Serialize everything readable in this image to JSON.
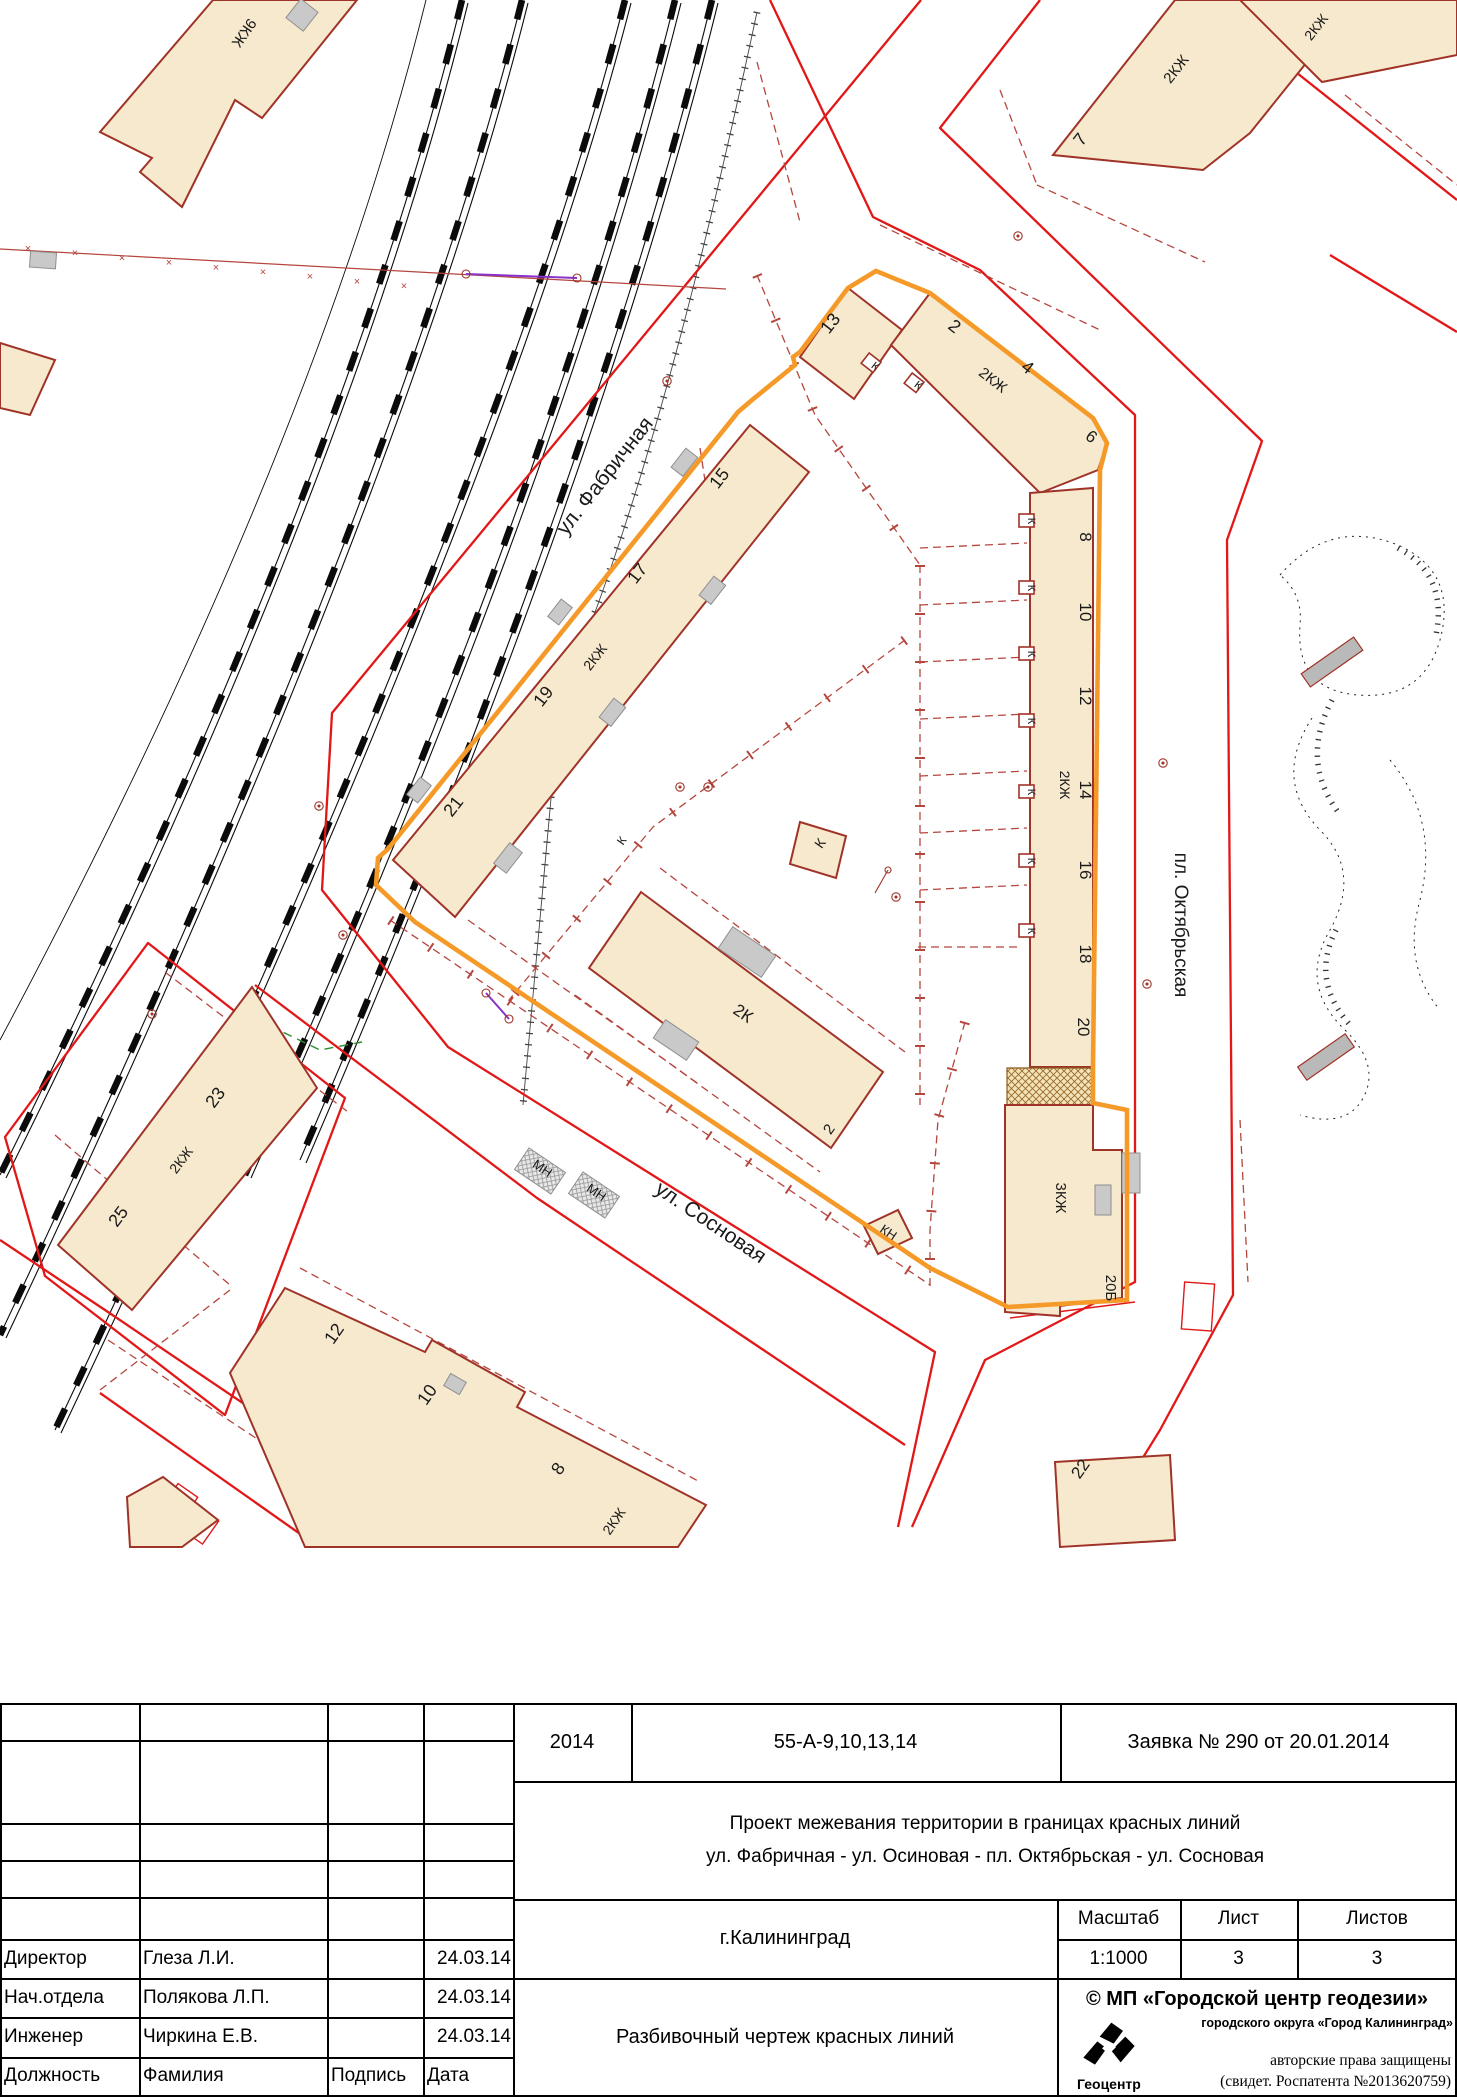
{
  "map": {
    "colors": {
      "red": "#e21717",
      "dred": "#a03328",
      "orange": "#f59a28",
      "beige": "#f7e9cd",
      "dash": "#b5463e",
      "green": "#2e8b2e",
      "violet": "#8833cc"
    },
    "street_labels": [
      {
        "text": "ул. Фабричная",
        "x": 610,
        "y": 480,
        "r": -52,
        "s": 21
      },
      {
        "text": "ул. Сосновая",
        "x": 707,
        "y": 1228,
        "r": 34,
        "s": 21
      },
      {
        "text": "пл. Октябрьская",
        "x": 1175,
        "y": 925,
        "r": 90,
        "s": 19
      }
    ],
    "labels": [
      {
        "text": "9КЖ",
        "x": 240,
        "y": 30,
        "r": 125,
        "s": 15
      },
      {
        "text": "13",
        "x": 835,
        "y": 327,
        "r": -52,
        "s": 18
      },
      {
        "text": "2",
        "x": 951,
        "y": 331,
        "r": 38,
        "s": 18
      },
      {
        "text": "2КЖ",
        "x": 990,
        "y": 384,
        "r": 38,
        "s": 15
      },
      {
        "text": "4",
        "x": 1024,
        "y": 372,
        "r": 38,
        "s": 18
      },
      {
        "text": "6",
        "x": 1088,
        "y": 441,
        "r": 38,
        "s": 17
      },
      {
        "text": "8",
        "x": 1080,
        "y": 537,
        "r": 90,
        "s": 17
      },
      {
        "text": "10",
        "x": 1080,
        "y": 612,
        "r": 90,
        "s": 17
      },
      {
        "text": "12",
        "x": 1080,
        "y": 696,
        "r": 90,
        "s": 17
      },
      {
        "text": "2КЖ",
        "x": 1060,
        "y": 785,
        "r": 90,
        "s": 14
      },
      {
        "text": "14",
        "x": 1080,
        "y": 790,
        "r": 90,
        "s": 17
      },
      {
        "text": "16",
        "x": 1080,
        "y": 870,
        "r": 90,
        "s": 17
      },
      {
        "text": "18",
        "x": 1080,
        "y": 954,
        "r": 90,
        "s": 17
      },
      {
        "text": "20",
        "x": 1078,
        "y": 1027,
        "r": 90,
        "s": 17
      },
      {
        "text": "3КЖ",
        "x": 1056,
        "y": 1198,
        "r": 90,
        "s": 15
      },
      {
        "text": "20Б",
        "x": 1106,
        "y": 1288,
        "r": 90,
        "s": 15
      },
      {
        "text": "15",
        "x": 724,
        "y": 482,
        "r": -52,
        "s": 18
      },
      {
        "text": "17",
        "x": 642,
        "y": 577,
        "r": -52,
        "s": 18
      },
      {
        "text": "2КЖ",
        "x": 599,
        "y": 660,
        "r": -52,
        "s": 14
      },
      {
        "text": "19",
        "x": 548,
        "y": 700,
        "r": -52,
        "s": 18
      },
      {
        "text": "21",
        "x": 458,
        "y": 810,
        "r": -52,
        "s": 18
      },
      {
        "text": "23",
        "x": 220,
        "y": 1101,
        "r": -53,
        "s": 18
      },
      {
        "text": "2КЖ",
        "x": 185,
        "y": 1163,
        "r": -53,
        "s": 14
      },
      {
        "text": "25",
        "x": 123,
        "y": 1220,
        "r": -53,
        "s": 18
      },
      {
        "text": "12",
        "x": 339,
        "y": 1337,
        "r": -55,
        "s": 18
      },
      {
        "text": "10",
        "x": 432,
        "y": 1398,
        "r": -55,
        "s": 18
      },
      {
        "text": "8",
        "x": 563,
        "y": 1472,
        "r": -55,
        "s": 18
      },
      {
        "text": "2КЖ",
        "x": 618,
        "y": 1524,
        "r": -55,
        "s": 14
      },
      {
        "text": "2К",
        "x": 740,
        "y": 1018,
        "r": 34,
        "s": 17
      },
      {
        "text": "2",
        "x": 833,
        "y": 1132,
        "r": -55,
        "s": 15
      },
      {
        "text": "К",
        "x": 824,
        "y": 846,
        "r": -55,
        "s": 14
      },
      {
        "text": "КН",
        "x": 886,
        "y": 1236,
        "r": 34,
        "s": 13
      },
      {
        "text": "МН",
        "x": 540,
        "y": 1172,
        "r": 34,
        "s": 13
      },
      {
        "text": "МН",
        "x": 594,
        "y": 1196,
        "r": 34,
        "s": 13
      },
      {
        "text": "22",
        "x": 1085,
        "y": 1472,
        "r": -55,
        "s": 17
      },
      {
        "text": "7",
        "x": 1085,
        "y": 143,
        "r": -52,
        "s": 18
      },
      {
        "text": "2КЖ",
        "x": 1180,
        "y": 72,
        "r": -52,
        "s": 15
      },
      {
        "text": "2КЖ",
        "x": 1320,
        "y": 30,
        "r": -52,
        "s": 14
      },
      {
        "text": "К",
        "x": 873,
        "y": 369,
        "r": 38,
        "s": 11
      },
      {
        "text": "К",
        "x": 916,
        "y": 388,
        "r": 38,
        "s": 11
      },
      {
        "text": "К",
        "x": 1028,
        "y": 521,
        "r": 90,
        "s": 11
      },
      {
        "text": "К",
        "x": 1028,
        "y": 588,
        "r": 90,
        "s": 11
      },
      {
        "text": "К",
        "x": 1028,
        "y": 654,
        "r": 90,
        "s": 11
      },
      {
        "text": "К",
        "x": 1028,
        "y": 721,
        "r": 90,
        "s": 11
      },
      {
        "text": "К",
        "x": 1028,
        "y": 792,
        "r": 90,
        "s": 11
      },
      {
        "text": "К",
        "x": 1028,
        "y": 861,
        "r": 90,
        "s": 11
      },
      {
        "text": "К",
        "x": 1028,
        "y": 931,
        "r": 90,
        "s": 11
      },
      {
        "text": "К",
        "x": 625,
        "y": 843,
        "r": -55,
        "s": 12
      }
    ],
    "fence_mark": "×"
  },
  "title_block": {
    "year": "2014",
    "code": "55-А-9,10,13,14",
    "request": "Заявка № 290 от 20.01.2014",
    "project_line1": "Проект межевания территории в границах красных линий",
    "project_line2": "ул. Фабричная - ул. Осиновая - пл. Октябрьская - ул. Сосновая",
    "city": "г.Калининград",
    "drawing_type": "Разбивочный чертеж красных линий",
    "scale_label": "Масштаб",
    "scale_value": "1:1000",
    "sheet_label": "Лист",
    "sheet_value": "3",
    "sheets_label": "Листов",
    "sheets_value": "3",
    "signatures": [
      {
        "role": "Директор",
        "name": "Глеза Л.И.",
        "sign": "",
        "date": "24.03.14"
      },
      {
        "role": "Нач.отдела",
        "name": "Полякова Л.П.",
        "sign": "",
        "date": "24.03.14"
      },
      {
        "role": "Инженер",
        "name": "Чиркина Е.В.",
        "sign": "",
        "date": "24.03.14"
      }
    ],
    "footer_headers": {
      "role": "Должность",
      "name": "Фамилия",
      "sign": "Подпись",
      "date": "Дата"
    },
    "copyright": {
      "org": "© МП «Городской центр геодезии»",
      "org2": "городского округа «Город Калининград»",
      "rights": "авторские права защищены",
      "cert": "(свидет. Роспатента №2013620759)",
      "logo_text": "Геоцентр"
    }
  }
}
